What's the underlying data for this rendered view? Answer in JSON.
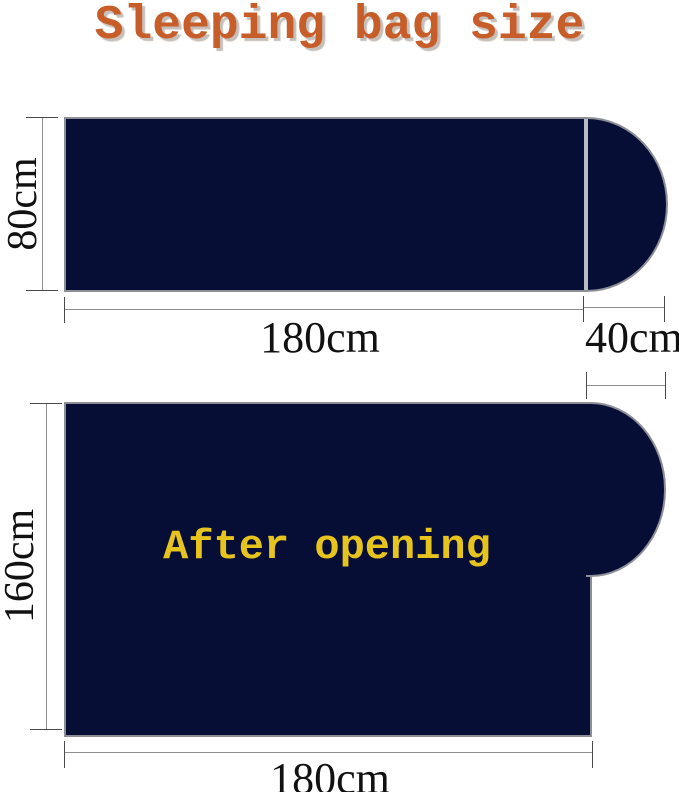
{
  "title": "Sleeping bag size",
  "colors": {
    "background": "#FFFFFF",
    "bag_navy": "#060E36",
    "title_orange": "#C75D28",
    "overlay_yellow": "#E7C31D",
    "outline_gray": "#8E8E96",
    "zipper_divider_gray": "#B9BAC2",
    "dimension_line_gray": "#8F8F8F",
    "dimension_text_black": "#111111"
  },
  "closed_bag": {
    "name": "Closed sleeping bag",
    "height": "80cm",
    "body_width": "180cm",
    "hood_width": "40cm"
  },
  "open_bag": {
    "name": "Opened sleeping bag",
    "overlay_label": "After opening",
    "height": "160cm",
    "width": "180cm"
  }
}
